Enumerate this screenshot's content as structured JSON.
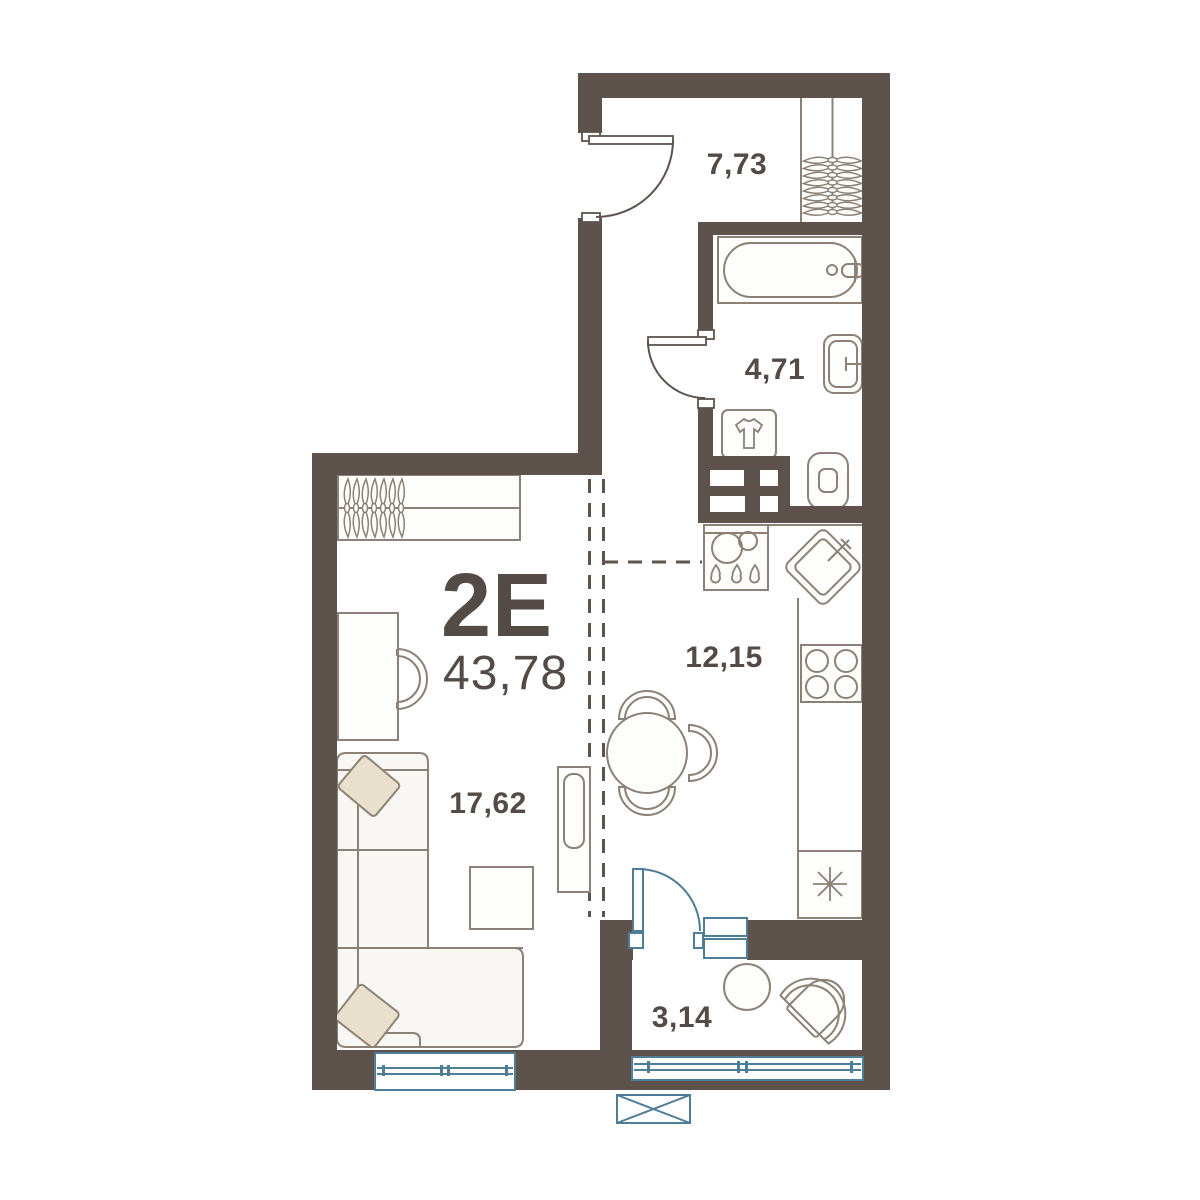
{
  "plan": {
    "apartment_type": "2E",
    "total_area": "43,78",
    "rooms": [
      {
        "id": "hallway",
        "area": "7,73"
      },
      {
        "id": "bathroom",
        "area": "4,71"
      },
      {
        "id": "kitchen",
        "area": "12,15"
      },
      {
        "id": "living-room",
        "area": "17,62"
      },
      {
        "id": "balcony",
        "area": "3,14"
      }
    ],
    "colors": {
      "wall": "#5e534c",
      "furniture_stroke": "#8b8177",
      "label_text": "#544a46",
      "accent_blue": "#4d7d97",
      "pillow_fill": "#e8e0cd"
    },
    "furniture_icons": [
      "entrance-door-icon",
      "hanger-icon",
      "bathtub-icon",
      "bath-sink-icon",
      "toilet-icon",
      "washer-tshirt-icon",
      "vent-shaft-icon",
      "washing-machine-icon",
      "kitchen-sink-icon",
      "stove-icon",
      "fridge-snowflake-icon",
      "dining-table-icon",
      "chair-icon",
      "desk-icon",
      "sofa-icon",
      "pillow-icon",
      "coffee-table-icon",
      "tv-stand-icon",
      "window-icon",
      "balcony-door-icon",
      "balcony-chair-icon",
      "balcony-table-icon",
      "air-conditioner-icon"
    ]
  }
}
